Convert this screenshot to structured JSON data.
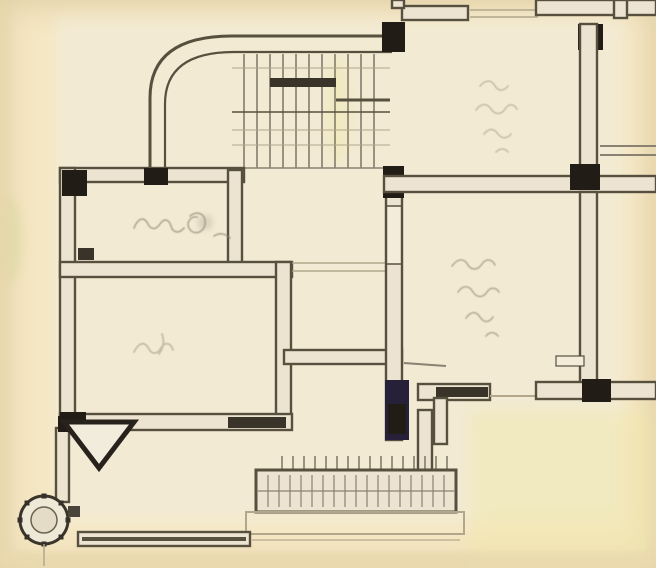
{
  "page": {
    "kind": "scanned hand-drawn architectural floor plan",
    "width_px": 656,
    "height_px": 568,
    "visible_text": "none legible"
  },
  "colors": {
    "paper": "#f5e7c3",
    "paper-light": "#f2ecd9",
    "paper-shade": "#ead9ae",
    "wall-fill": "#ece4d0",
    "ink": "#57503e",
    "ink-dark": "#39332a",
    "column": "#211c16",
    "column-tint": "#262038",
    "hatch": "#7d7465",
    "thin-line": "#8a8172",
    "faint-line": "#b2a78c",
    "handwriting": "#8f8570",
    "tint-green": "#d6d69a",
    "tint-yellow": "#f0e8a8"
  },
  "features": [
    {
      "id": "staircase",
      "description": "curved quarter-turn staircase with treads, top left"
    },
    {
      "id": "upper-left-room",
      "description": "small room with handwritten label and door mark"
    },
    {
      "id": "left-room",
      "description": "large room lower left with handwritten label"
    },
    {
      "id": "top-right-room",
      "description": "room upper right with corner columns and handwritten label"
    },
    {
      "id": "middle-right-room",
      "description": "room right middle with handwritten label and door openings"
    },
    {
      "id": "balcony-right",
      "description": "narrow balcony strip along right edge with rail line"
    },
    {
      "id": "entrance-porch",
      "description": "hatched entrance steps, bottom center"
    },
    {
      "id": "entry-arrow",
      "description": "triangular entry marker, bottom left"
    },
    {
      "id": "round-column",
      "description": "decorated circular column, bottom left corner"
    }
  ],
  "annotations": [
    {
      "room": "upper-left-room",
      "text": "",
      "legible": false,
      "style": "handwritten cursive"
    },
    {
      "room": "left-room",
      "text": "",
      "legible": false,
      "style": "handwritten cursive"
    },
    {
      "room": "top-right-room",
      "text": "",
      "legible": false,
      "style": "handwritten cursive"
    },
    {
      "room": "middle-right-room",
      "text": "",
      "legible": false,
      "style": "handwritten cursive"
    }
  ]
}
